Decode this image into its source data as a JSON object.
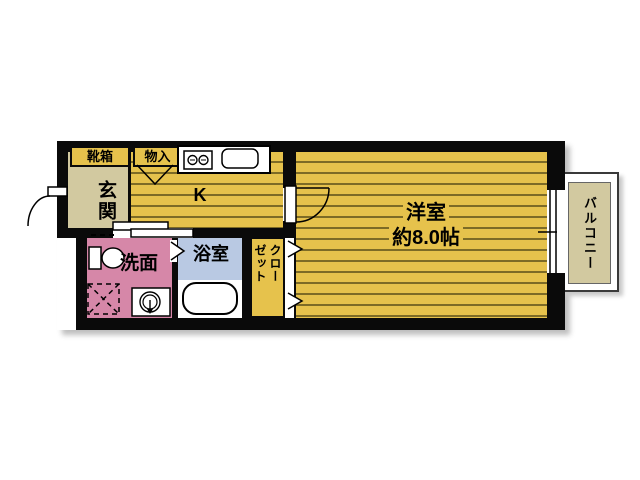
{
  "rooms": {
    "entrance": {
      "label": "玄関"
    },
    "shoe_box": {
      "label": "靴箱"
    },
    "storage": {
      "label": "物入"
    },
    "kitchen": {
      "label": "K"
    },
    "main_room": {
      "label": "洋室",
      "area": "約8.0帖"
    },
    "balcony": {
      "label": "バルコニー"
    },
    "washroom": {
      "label": "洗面"
    },
    "bathroom": {
      "label": "浴室"
    },
    "closet": {
      "label": "クローゼット",
      "label_lines": [
        "クロー",
        "ゼット"
      ]
    }
  },
  "colors": {
    "floor_yellow": "#e6c24c",
    "floor_stripe": "#7d6b26",
    "entrance_beige": "#d2c9a0",
    "washroom_pink": "#d687a8",
    "bathroom_blue": "#b9c9e3",
    "wall_black": "#0a0a0a",
    "balcony_beige": "#d2c9a0"
  }
}
